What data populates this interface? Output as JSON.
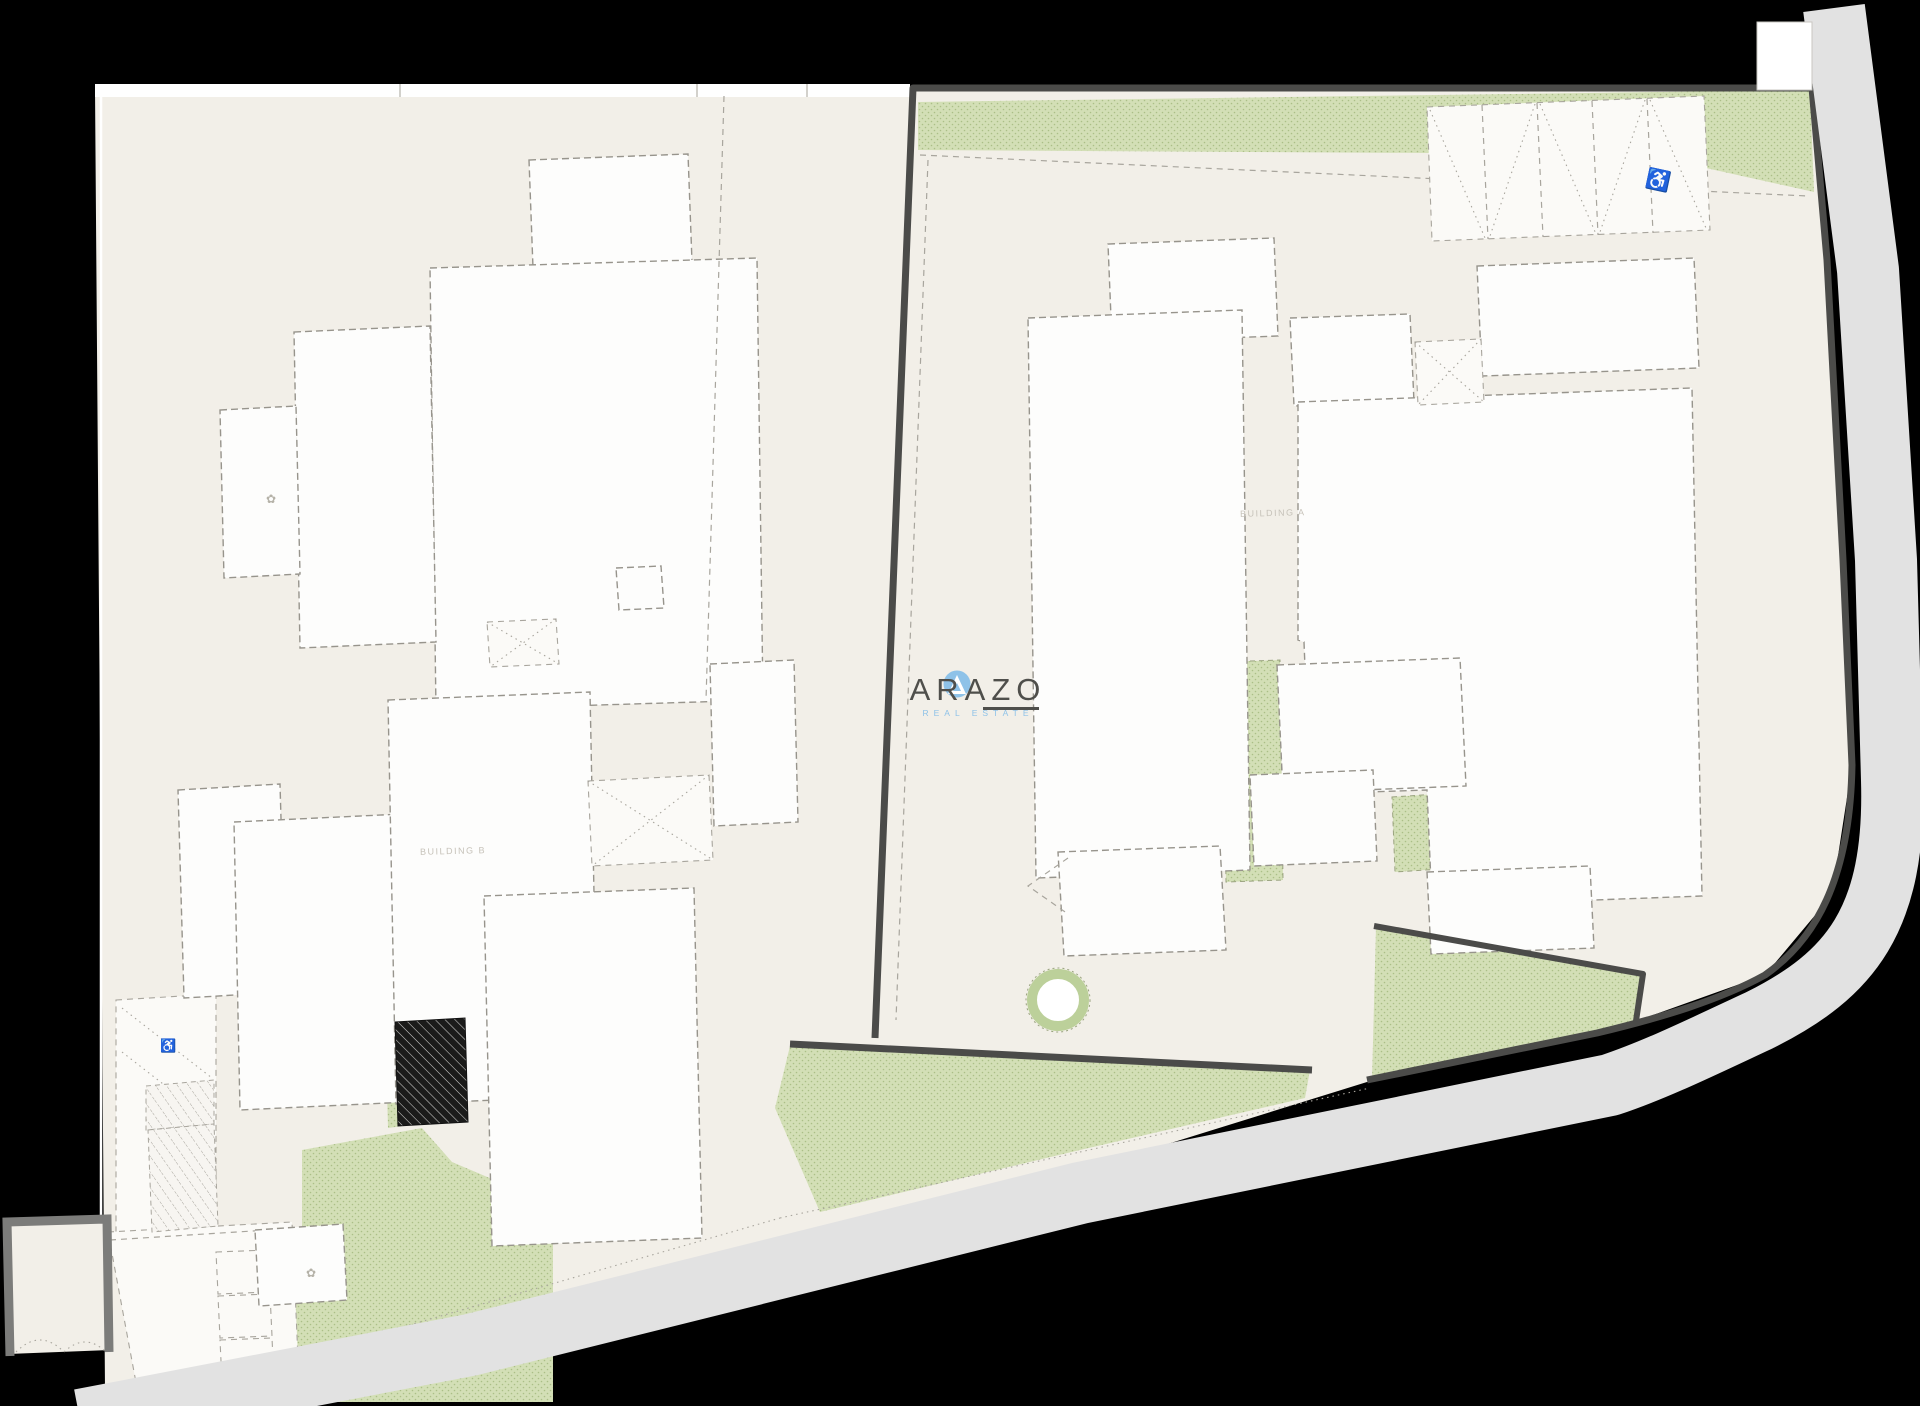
{
  "page": {
    "type": "architectural-site-plan",
    "description": "Black-backed site plan of two parcels with white building footprints, green landscaping, kerbside road and parking"
  },
  "logo": {
    "name": "ARAZO",
    "tagline": "REAL ESTATE",
    "icon": "triangle-in-circle-icon"
  },
  "labels": {
    "building_a": "BUILDING A",
    "building_b": "BUILDING B"
  },
  "symbols": {
    "accessible_parking": "♿",
    "accessible_ramp": "♿",
    "shrub_1": "✿",
    "shrub_2": "✿"
  },
  "parking": {
    "top_right_stall_count": 5,
    "accessible_stall": "rightmost",
    "bottom_left_stall_count": 3
  },
  "colors": {
    "background": "#000000",
    "parcel": "#f2efe8",
    "sidewalk": "#ffffff",
    "paving": "#fbfaf7",
    "building_fill": "#fdfdfc",
    "building_outline": "#97948c",
    "grass_fill": "#d3dfb6",
    "grass_dot": "#abbf87",
    "grass_edge": "#9aa37f",
    "boundary": "#4b4b49",
    "road": "#e2e2e2",
    "wall": "#7c7c7a",
    "dash_line": "#a8a59d",
    "planter": "#bcd09a",
    "logo_blue": "#8ec2e8",
    "logo_text": "#4f4f4b",
    "label": "#c6c2b9"
  }
}
